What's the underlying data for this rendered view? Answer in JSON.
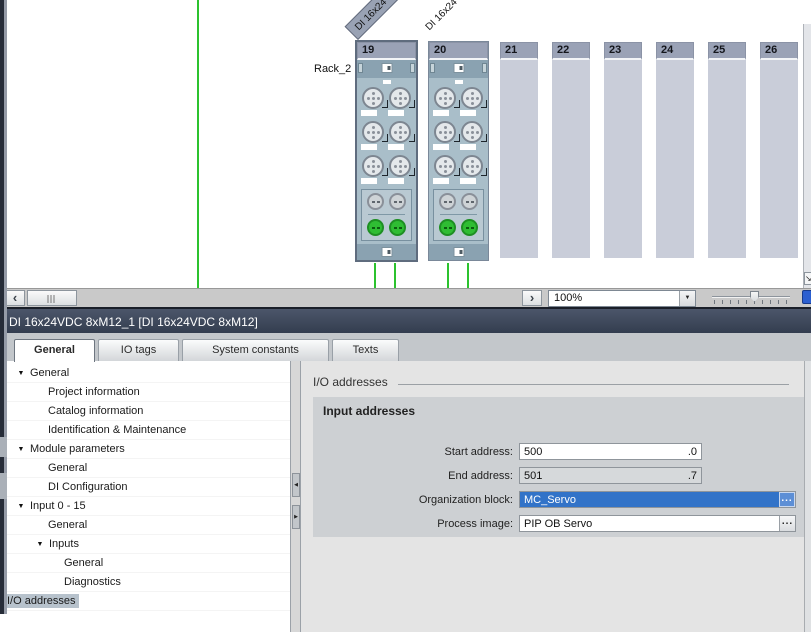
{
  "hardware_view": {
    "rack_label": "Rack_2",
    "ribbons": [
      "DI 16x24",
      "DI 16x24"
    ],
    "modules": [
      {
        "slot": "19"
      },
      {
        "slot": "20"
      }
    ],
    "empty_slots": [
      "21",
      "22",
      "23",
      "24",
      "25",
      "26"
    ],
    "zoom_value": "100%"
  },
  "properties": {
    "title": "DI 16x24VDC 8xM12_1 [DI 16x24VDC 8xM12]",
    "tabs": [
      {
        "label": "General"
      },
      {
        "label": "IO tags"
      },
      {
        "label": "System constants"
      },
      {
        "label": "Texts"
      }
    ],
    "nav": [
      {
        "label": "General"
      },
      {
        "label": "Project information"
      },
      {
        "label": "Catalog information"
      },
      {
        "label": "Identification & Maintenance"
      },
      {
        "label": "Module parameters"
      },
      {
        "label": "General"
      },
      {
        "label": "DI Configuration"
      },
      {
        "label": "Input 0 - 15"
      },
      {
        "label": "General"
      },
      {
        "label": "Inputs"
      },
      {
        "label": "General"
      },
      {
        "label": "Diagnostics"
      },
      {
        "label": "I/O addresses"
      }
    ],
    "section_title": "I/O addresses",
    "group_title": "Input addresses",
    "fields": [
      {
        "label": "Start address:",
        "value": "500",
        "suffix": ".0"
      },
      {
        "label": "End address:",
        "value": "501",
        "suffix": ".7"
      },
      {
        "label": "Organization block:",
        "value": "MC_Servo"
      },
      {
        "label": "Process image:",
        "value": "PIP OB Servo"
      }
    ]
  },
  "icons": {
    "chevron_left": "‹",
    "chevron_right": "›",
    "dropdown": "▼",
    "tree_expanded": "▼",
    "split_left": "◀",
    "split_right": "▶",
    "diag_arrow": "↘",
    "browse": "..."
  },
  "colors": {
    "selection_blue": "#3273c8",
    "wire_green": "#2cc22e",
    "titlebar": "#3d4557",
    "nav_highlight": "#b7c2cc"
  }
}
